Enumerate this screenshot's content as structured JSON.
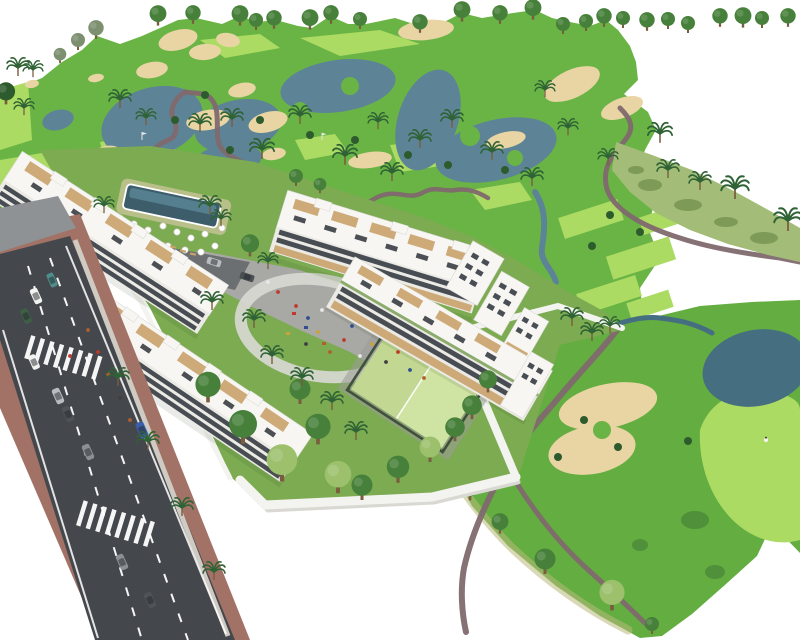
{
  "scene": {
    "type": "architectural-aerial-render",
    "description": "Aerial 3D rendering of a white low-rise apartment complex with swimming pool, padel court, playground plaza and perimeter wall, set beside a landscaped golf course with fairways, lakes, sand bunkers, cart paths and palm trees; an access road with cars and zebra crossings runs along the left edge.",
    "width_px": 800,
    "height_px": 640,
    "background": "#ffffff"
  },
  "palette": {
    "canvas": "#ffffff",
    "fairway": "#6ab446",
    "fairwayAlt": "#74bd4c",
    "fieldGreen": "#63ad41",
    "lightGreen": "#abdb63",
    "rough": "#a3bd78",
    "roughBlotch": "#74914f",
    "gardenLawn": "#7cab52",
    "treeDark": "#2e5b2d",
    "treeMid": "#47803a",
    "treeLight": "#9cc06c",
    "treeGray": "#7c9070",
    "palmGreen": "#2f6234",
    "trunk": "#7a5c3e",
    "water": "#5d8496",
    "waterDeep": "#456e81",
    "sand": "#e9d5a4",
    "path": "#7f696e",
    "pathKhaki": "#b9b97b",
    "road": "#44484d",
    "roadLine": "#ffffff",
    "sidewalk": "#a17265",
    "pavement": "#8f9294",
    "curb": "#cfcac2",
    "driveway": "#6b6f72",
    "building": "#f7f6f3",
    "facade": "#eceae5",
    "facadeShadow": "#dcdad4",
    "windowDark": "#3a3f46",
    "wood": "#c9a26a",
    "planter": "#6f9a4a",
    "roofItem": "#2e3237",
    "wall": "#f3f3ef",
    "wallShade": "#d9d8d2",
    "pool": "#3d5d6b",
    "poolLight": "#5b8799",
    "deck": "#d9c9a8",
    "court": "#cfe3a2",
    "courtDark": "#c2d892",
    "fence": "#41503d",
    "plaza": "#a8a8a4",
    "plazaPath": "#d9d9d5",
    "umbrella": "#ffffff",
    "flag": "#e9e9e9",
    "cart": "#f4f4f2"
  },
  "cars": [
    {
      "label": "white-van",
      "color": "#f2f2f0"
    },
    {
      "label": "teal-car",
      "color": "#4e8d8a"
    },
    {
      "label": "dark-green-car",
      "color": "#3e5f46"
    },
    {
      "label": "silver-car",
      "color": "#b9bdc0"
    },
    {
      "label": "dark-gray-car",
      "color": "#4e5357"
    },
    {
      "label": "gray-car",
      "color": "#8b9094"
    },
    {
      "label": "blue-car",
      "color": "#3a5fa8"
    },
    {
      "label": "white-car",
      "color": "#f2f2f0"
    },
    {
      "label": "gray-car-2",
      "color": "#8b9094"
    },
    {
      "label": "dark-gray-car-2",
      "color": "#4e5357"
    },
    {
      "label": "plaza-silver-car",
      "color": "#b9bdc0"
    },
    {
      "label": "plaza-dark-car",
      "color": "#4a4f54"
    }
  ],
  "people": {
    "colors": [
      "#c0392b",
      "#2f4f8f",
      "#e8e8e6",
      "#caa23a",
      "#3f3f3f",
      "#b06030"
    ]
  },
  "icons": [
    "palm-icon",
    "tree-icon",
    "bush-icon",
    "umbrella-icon",
    "car-icon",
    "flag-icon",
    "person-dot",
    "golf-cart-icon",
    "golfer-icon"
  ]
}
